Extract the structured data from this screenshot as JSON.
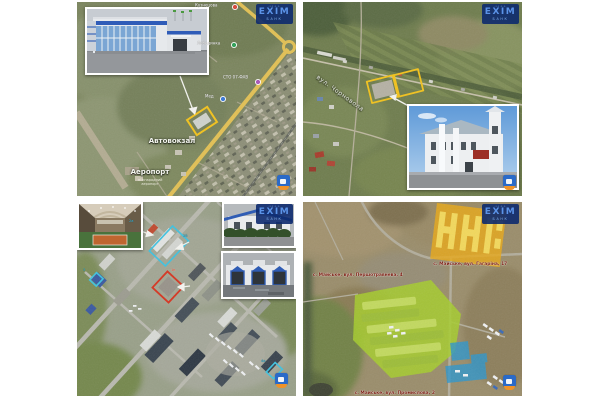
{
  "page": {
    "background": "#ffffff"
  },
  "brand": {
    "logo_top": "·ı·ı·ı·ı·",
    "logo_main": "ЕХІМ",
    "logo_bottom": "БАНК",
    "logo_bg": "#0d2a6e",
    "logo_fg": "#5b93e8"
  },
  "badge": {
    "square_color": "#2a6ac8",
    "base_color": "#ef9228"
  },
  "panels": {
    "bus_station": {
      "label_bus_station": "Автовокзал",
      "label_airport": "Аеропорт",
      "airport_note_1": "міжнародний",
      "airport_note_2": "аеропорт",
      "poi_1": "Кузнецова",
      "poi_2": "Лебединка",
      "poi_3": "СТО 07-ФАВ",
      "poi_4": "Мед",
      "outline_color": "#f2c21c"
    },
    "chornovola": {
      "street_label": "вул. Чорновола",
      "outline_color": "#f2c21c"
    },
    "industrial": {
      "mark_1": "2а",
      "mark_2": "2б",
      "mark_3": "1в",
      "mark_4": "3",
      "mark_5": "4а",
      "outline_cyan": "#3ec2e0",
      "outline_red": "#d63420"
    },
    "maiske": {
      "addr_yellow": "с. Майське, вул. Гагаріна, 17",
      "addr_green": "с. Майське, вул. Першотравнева, 4",
      "addr_blue": "с. Майське, вул. Промислова, 2",
      "zone_yellow": "#e8a818",
      "zone_green": "#a6cc2e",
      "zone_blue": "#2e96cc"
    }
  }
}
